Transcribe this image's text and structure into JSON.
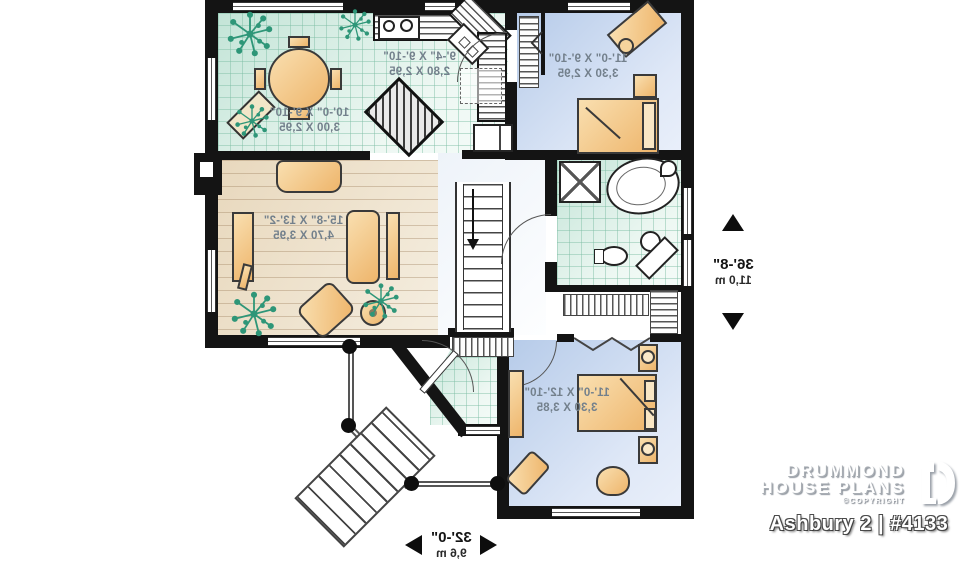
{
  "plan": {
    "rooms": {
      "dining": {
        "dim_ft": "10'-0\" X 9'-10\"",
        "dim_m": "3,00 X 2,95"
      },
      "kitchen": {
        "dim_ft": "9'-4\" X 9'-10\"",
        "dim_m": "2,80 X 2,95"
      },
      "bedroom2": {
        "dim_ft": "11'-0\" X 9'-10\"",
        "dim_m": "3,30 X 2,95"
      },
      "living": {
        "dim_ft": "15'-8\" X 13'-2\"",
        "dim_m": "4,70 X 3,95"
      },
      "master": {
        "dim_ft": "11'-0\" X 12'-10\"",
        "dim_m": "3,30 X 3,85"
      }
    },
    "overall": {
      "depth_ft": "36'-8\"",
      "depth_m": "11,0 m",
      "width_ft": "32'-0\"",
      "width_m": "9,6 m"
    }
  },
  "branding": {
    "name_line1": "DRUMMOND",
    "name_line2": "HOUSE PLANS",
    "copyright": "©COPYRIGHT",
    "plan_title": "Ashbury 2 | #4133"
  },
  "colors": {
    "wall": "#141414",
    "tile_floor": "#d9eee5",
    "wood_floor": "#eadcc3",
    "bedroom_floor": "#c5d4ee",
    "furniture": "#f3c382",
    "plant": "#2e9678",
    "label_text": "#73808c"
  }
}
